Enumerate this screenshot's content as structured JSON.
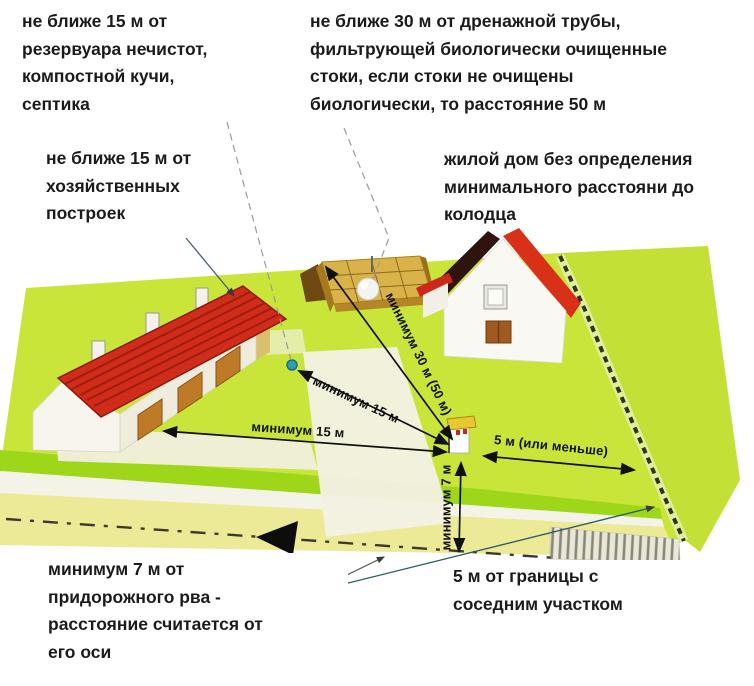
{
  "annotations": {
    "cesspool_rule": "не ближе 15 м от\nрезервуара нечистот,\nкомпостной кучи,\nсептика",
    "outbuildings_rule": "не ближе 15 м от\nхозяйственных\nпостроек",
    "drainpipe_rule": "не ближе 30 м от дренажной трубы,\nфильтрующей биологически очищенные\nстоки, если стоки не очищены\nбиологически, то расстояние 50 м",
    "house_rule": "жилой дом без определения\nминимального расстояни до\nколодца",
    "ditch_rule": "минимум 7 м от\nпридорожного рва -\nрасстояние считается от\nего оси",
    "boundary_rule": "5 м от границы с\nсоседним участком"
  },
  "measurements": {
    "barn_to_well": "минимум 15 м",
    "cesspool_to_well": "минимум 15 м",
    "drainfield_to_well": "минимум 30 м (50 м)",
    "well_to_fence": "5 м (или меньше)",
    "well_to_ditch": "минимум 7 м"
  },
  "objects": {
    "plot": "plot-of-land",
    "barn": "outbuilding-barn",
    "house": "dwelling-house",
    "drain_field": "septic-drain-field",
    "well": "water-well",
    "cesspool_marker": "cesspool-point",
    "fence": "boundary-fence",
    "road": "road-with-ditch"
  },
  "colors": {
    "field": "#c9e53a",
    "neighbor_field": "#c3e036",
    "field_edge": "#9ed619",
    "road": "#ecea96",
    "roof_barn": "#cf2c1a",
    "roof_house": "#d93018",
    "roof_house_shaded": "#2e130e",
    "drain_field": "#d9b34a",
    "fence": "#34311d",
    "well_cap": "#e9c72e",
    "water_marker": "#2d9fae",
    "ink": "#1b1b1b"
  }
}
